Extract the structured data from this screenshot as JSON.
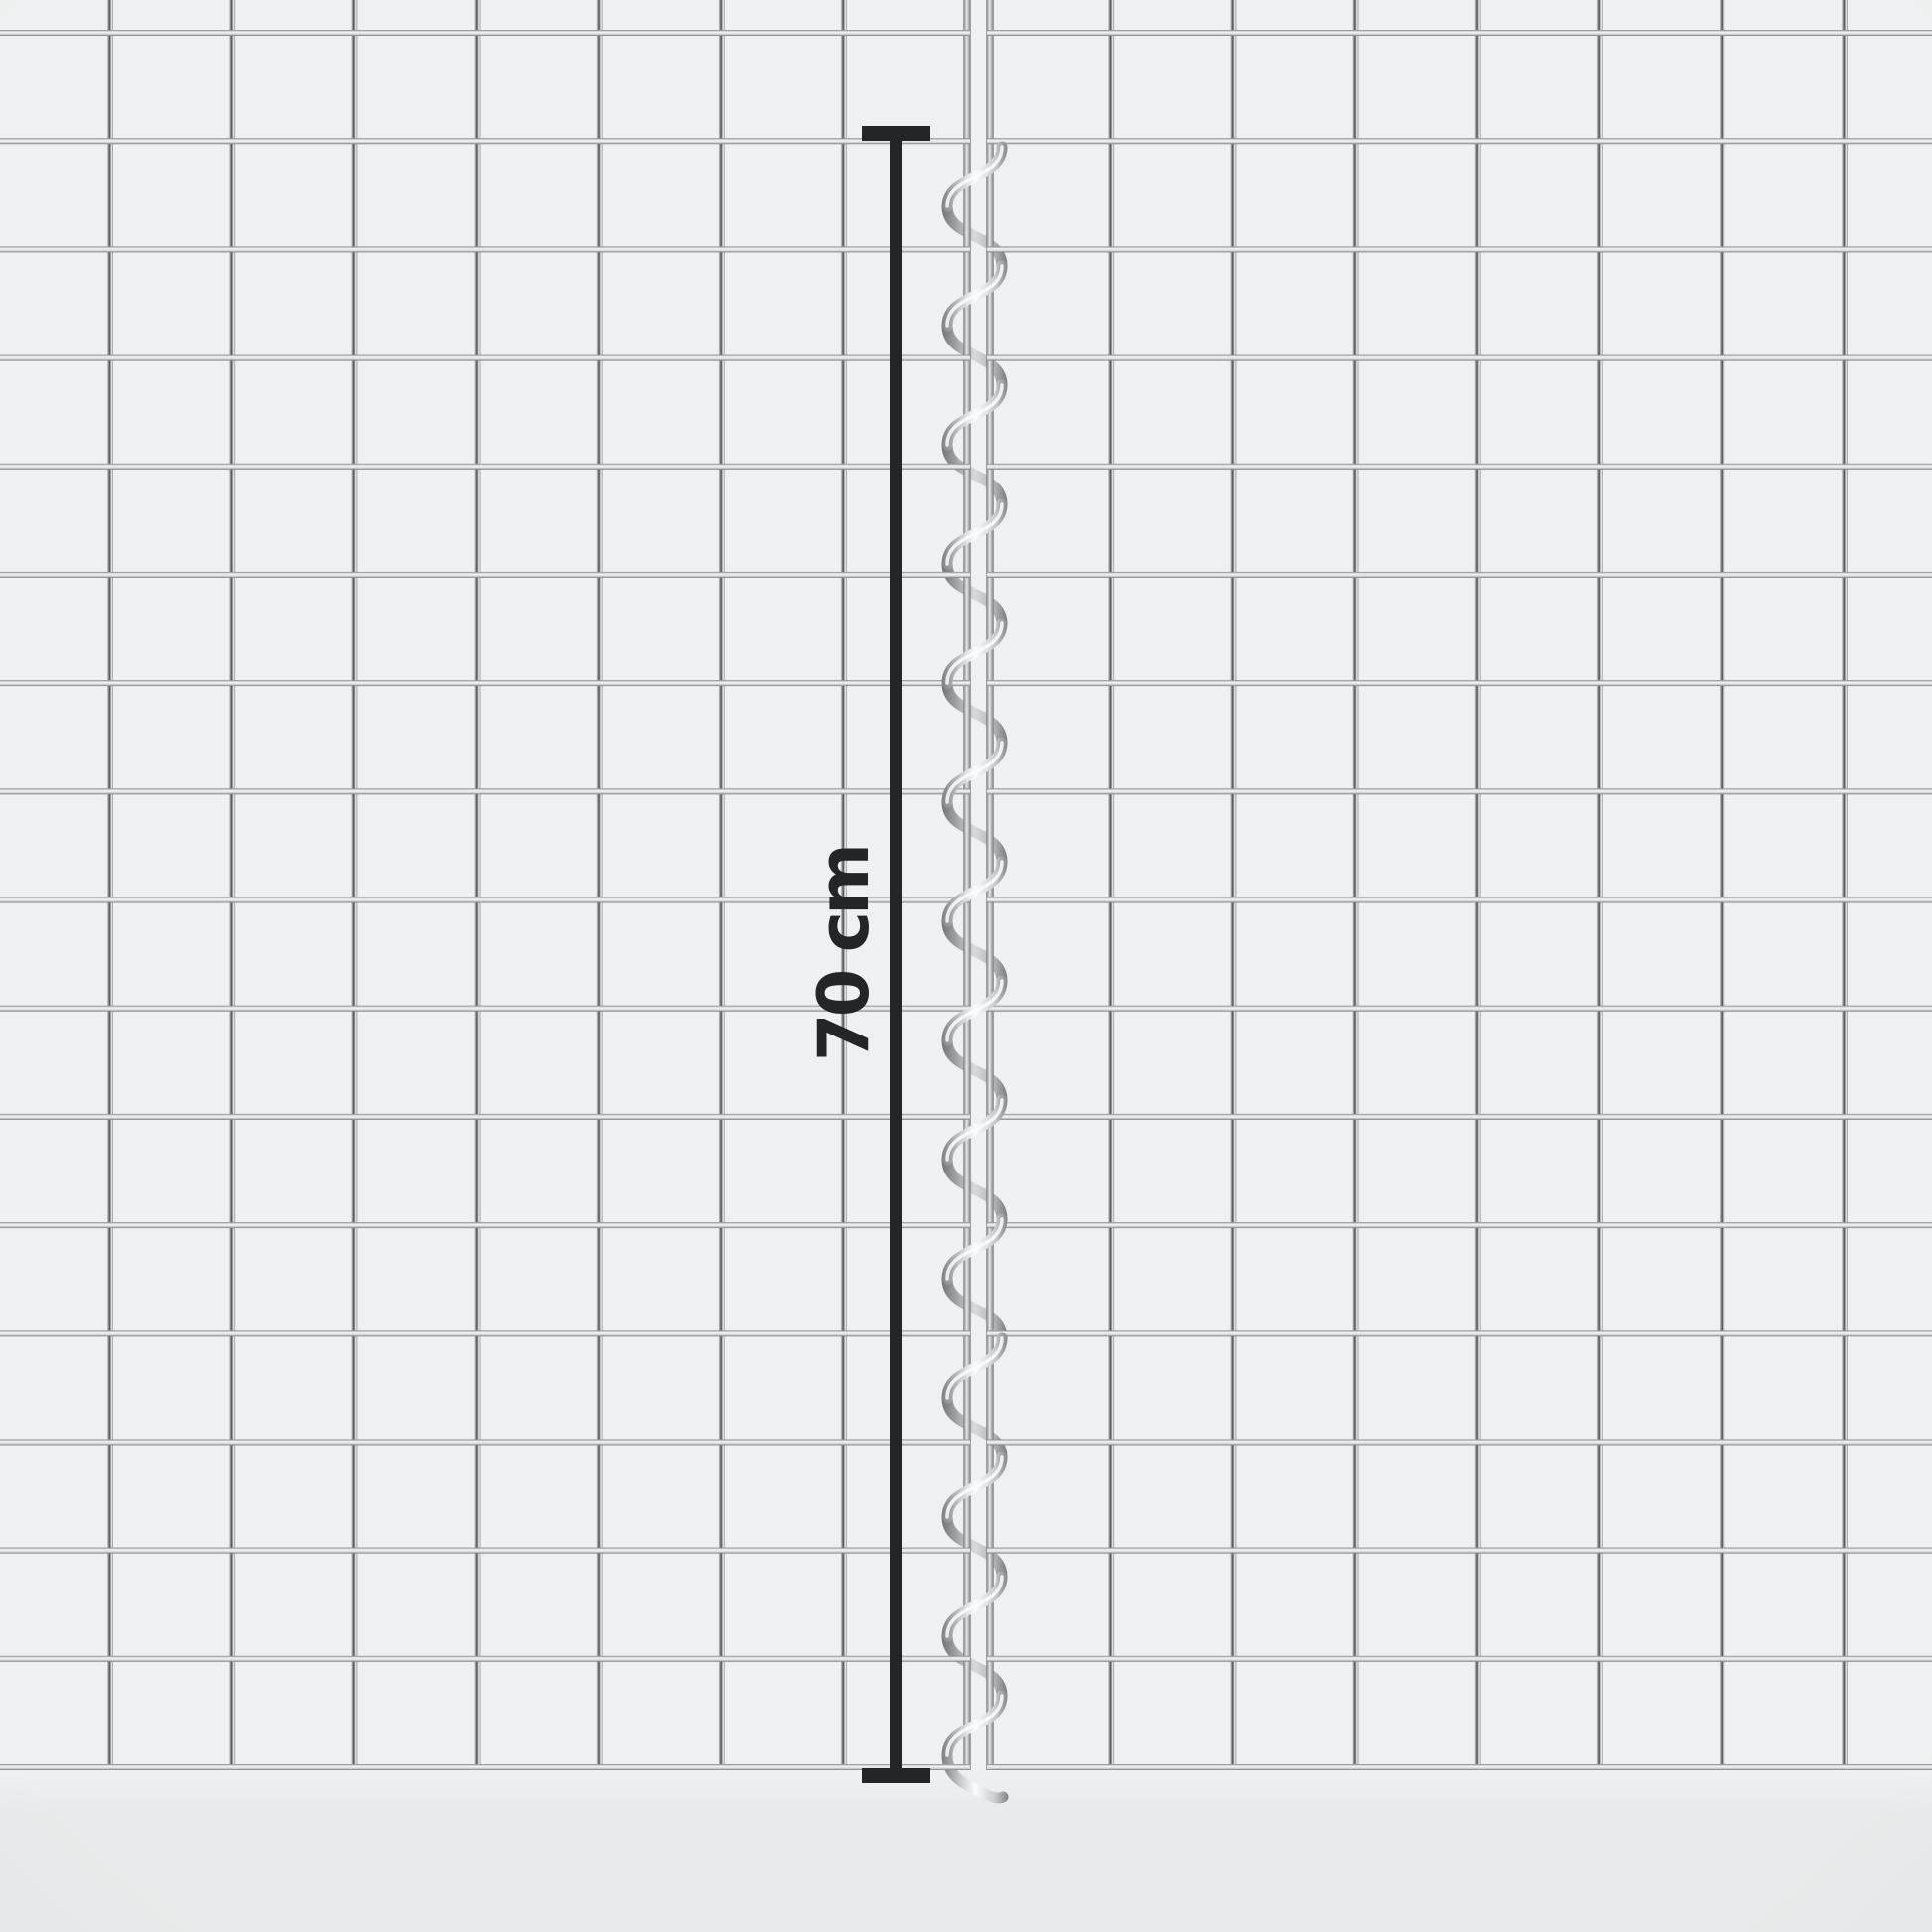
{
  "measurement": {
    "label": "70 cm",
    "color": "#232528"
  },
  "mesh": {
    "left_panel_columns": 8,
    "right_panel_columns": 8,
    "rows": 17,
    "joiner": "spiral-wire-connector"
  },
  "colors": {
    "page_bg": "#eef0f1",
    "below_bg": "#e8eaeb",
    "wire_light": "#d9dbdd",
    "wire_sheen": "#f2f4f5",
    "wire_core": "#4a4d50",
    "wire_dark": "#84878a",
    "edge_dark": "#75787b",
    "edge_light": "#e6e8e9",
    "spiral_dark": "#737678",
    "spiral_mid": "#c9cccd",
    "spiral_light": "#fbfcfd"
  }
}
